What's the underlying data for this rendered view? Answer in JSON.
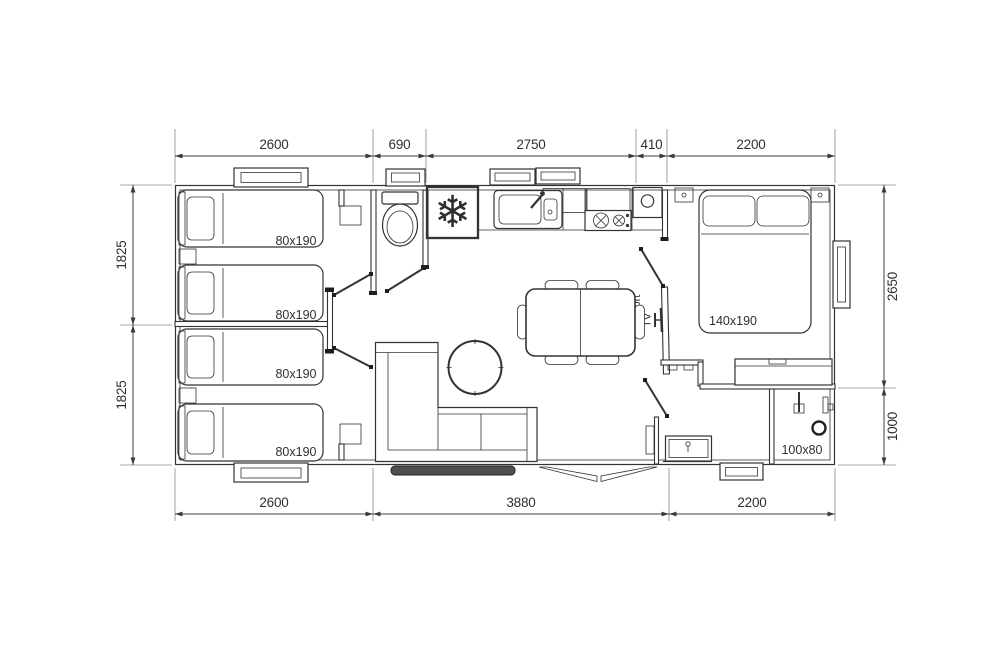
{
  "meta": {
    "title": "Mobile home floor plan"
  },
  "colors": {
    "line": "#333333",
    "dim_text": "#3a3a3a",
    "snowflake_blue": "#3c4797",
    "bay_window_strip": "#4f4f4f"
  },
  "dimensions": {
    "top": [
      {
        "label": "2600"
      },
      {
        "label": "690"
      },
      {
        "label": "2750"
      },
      {
        "label": "410"
      },
      {
        "label": "2200"
      }
    ],
    "bottom": [
      {
        "label": "2600"
      },
      {
        "label": "3880"
      },
      {
        "label": "2200"
      }
    ],
    "left": [
      {
        "label": "1825"
      },
      {
        "label": "1825"
      }
    ],
    "right": [
      {
        "label": "2650"
      },
      {
        "label": "1000"
      }
    ]
  },
  "labels": {
    "beds_small": [
      {
        "label": "80x190"
      },
      {
        "label": "80x190"
      },
      {
        "label": "80x190"
      },
      {
        "label": "80x190"
      }
    ],
    "bed_master": "140x190",
    "shower": "100x80",
    "tv_support_line1": "support",
    "tv_support_line2": "TV"
  },
  "icons": {
    "fridge_snowflake": "❄"
  }
}
